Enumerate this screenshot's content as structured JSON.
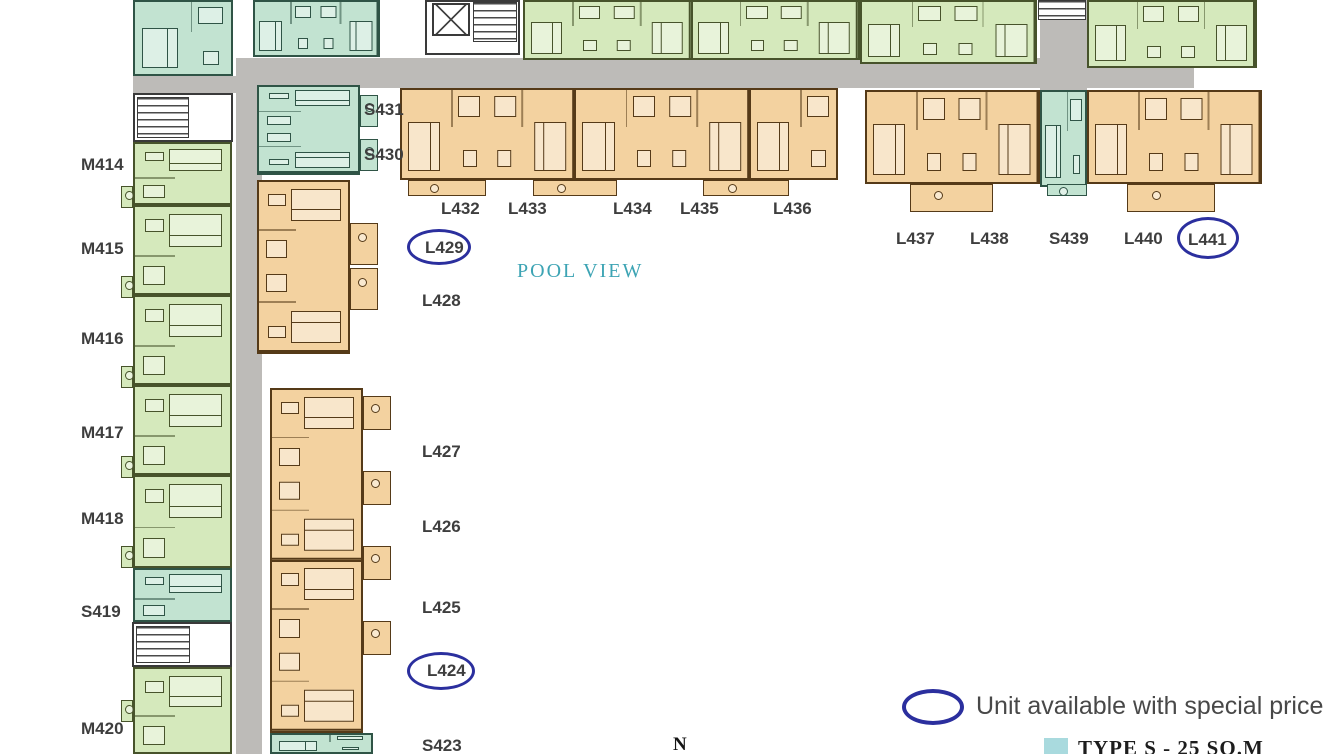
{
  "palette": {
    "type_m_green": "#d5e9bc",
    "type_s_teal": "#c2e3d1",
    "type_l_orange": "#f3d2a0",
    "corridor_gray": "#bdbbb8",
    "highlight_blue": "#2b2f9e",
    "pool_text_teal": "#3da4b4",
    "type_s_legend_swatch": "#a9dade"
  },
  "labels": {
    "M414": "M414",
    "M415": "M415",
    "M416": "M416",
    "M417": "M417",
    "M418": "M418",
    "S419": "S419",
    "M420": "M420",
    "S431": "S431",
    "S430": "S430",
    "L432": "L432",
    "L433": "L433",
    "L434": "L434",
    "L435": "L435",
    "L436": "L436",
    "L437": "L437",
    "L438": "L438",
    "S439": "S439",
    "L440": "L440",
    "L441": "L441",
    "L429": "L429",
    "L428": "L428",
    "L427": "L427",
    "L426": "L426",
    "L425": "L425",
    "L424": "L424",
    "S423": "S423"
  },
  "texts": {
    "pool_view": "POOL VIEW",
    "compass": "N"
  },
  "legend": {
    "special_price": "Unit available with special price",
    "type_s": "TYPE S - 25 SQ.M"
  },
  "highlighted_units": [
    "L429",
    "L424",
    "L441"
  ]
}
